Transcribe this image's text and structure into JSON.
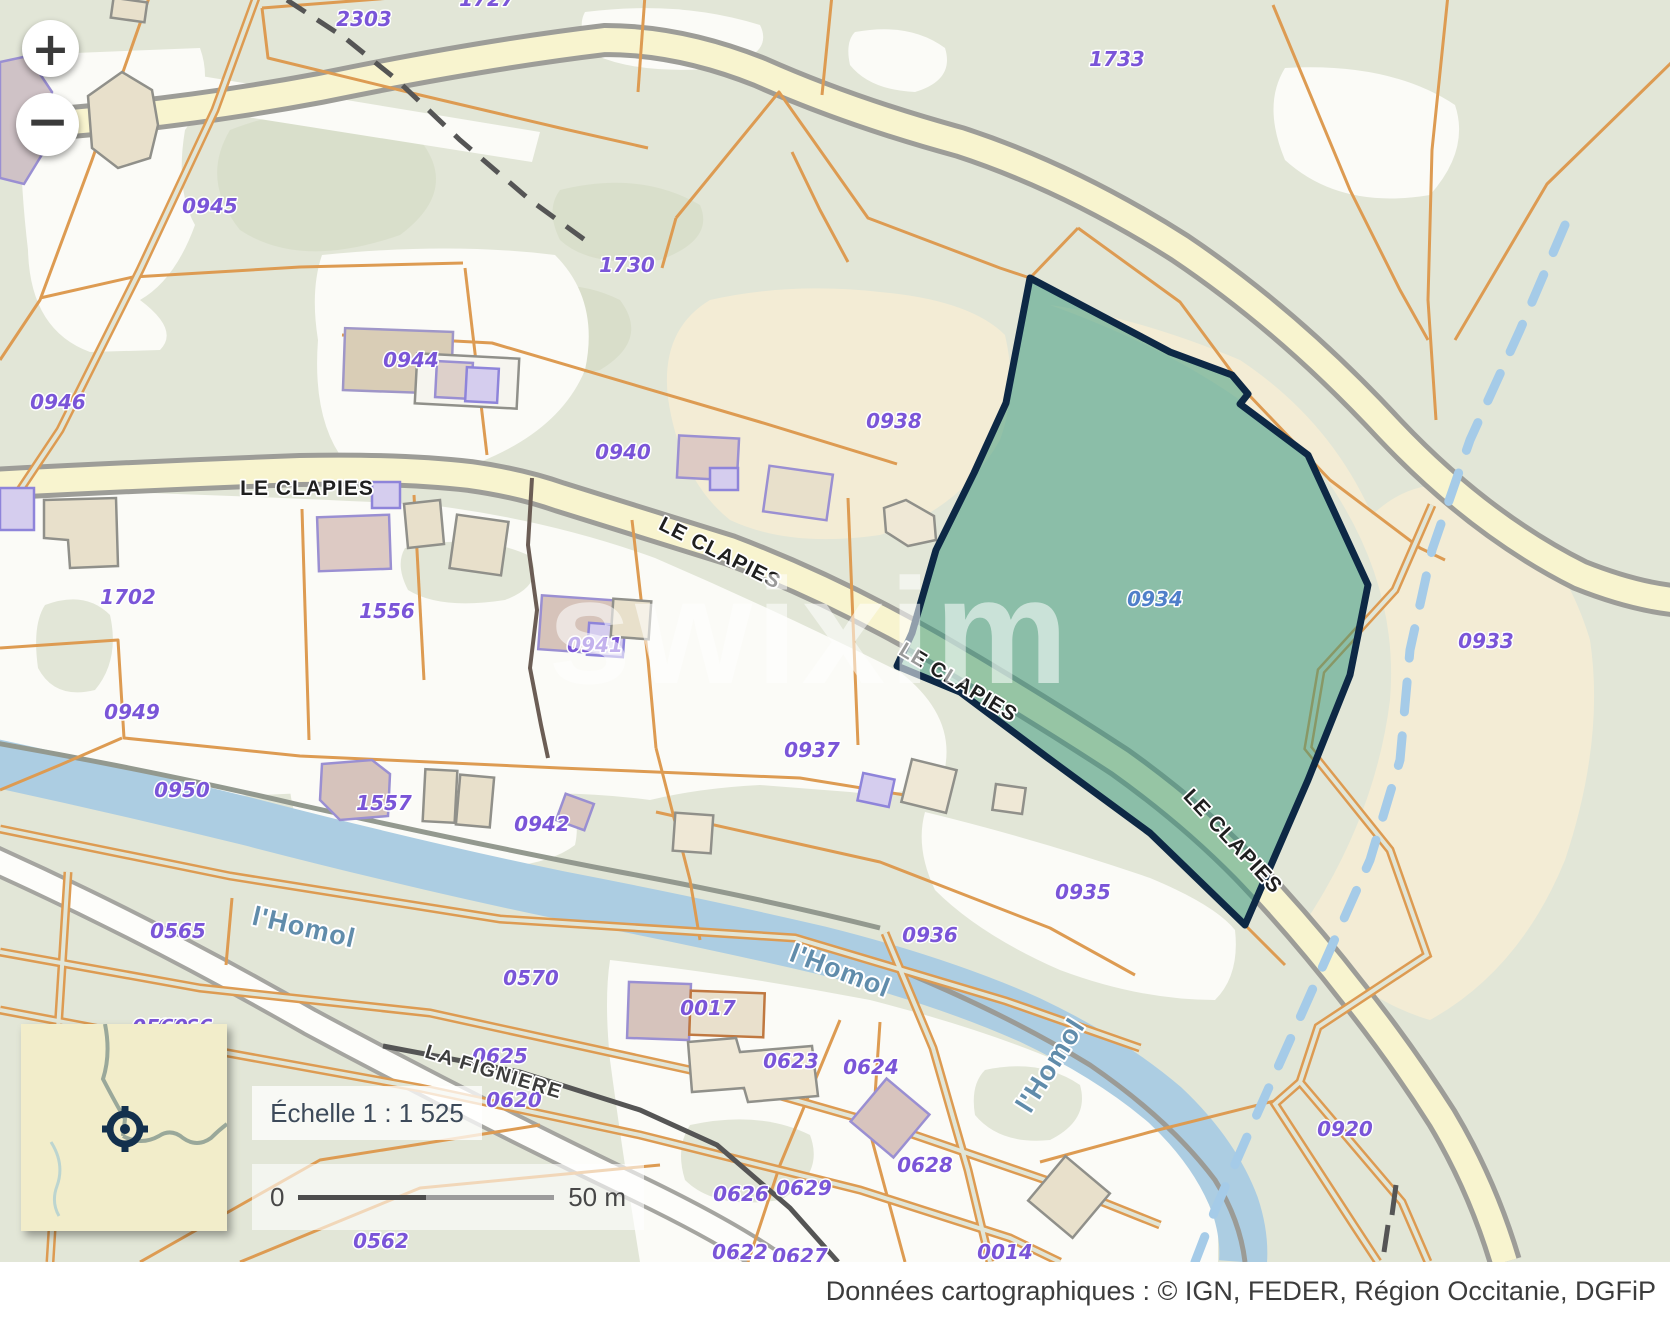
{
  "colors": {
    "base_green": "#e2e6d7",
    "patch_green": "#d7ddc8",
    "white_parcel": "#fbfbf7",
    "beige": "#f3ecd5",
    "river": "#accde2",
    "road_fill": "#f8f4cf",
    "road_casing": "#9d9d98",
    "orange_line": "#dd9b52",
    "highlight_fill": "rgba(52,150,122,0.5)",
    "highlight_border": "#0d2845",
    "parcel_label": "#7a55d8",
    "selected_parcel_label": "#4f7fc9",
    "dashed_stream": "#a5cbe8"
  },
  "controls": {
    "zoom_in": "+",
    "zoom_out": "−"
  },
  "scale": {
    "text": "Échelle 1 : 1 525",
    "bar_start": "0",
    "bar_end": "50 m"
  },
  "watermark": {
    "text": "swixim"
  },
  "attribution": {
    "text": "Données cartographiques : ©    IGN,  FEDER,  Région Occitanie,  DGFiP"
  },
  "selected_parcel": {
    "id": "0934"
  },
  "map_labels": [
    {
      "text": "1727",
      "x": 487,
      "y": 6,
      "rot": 0,
      "cls": "p",
      "name": "parcel-label-1727"
    },
    {
      "text": "2303",
      "x": 364,
      "y": 26,
      "rot": 0,
      "cls": "p",
      "name": "parcel-label-2303"
    },
    {
      "text": "1733",
      "x": 1117,
      "y": 66,
      "rot": 0,
      "cls": "p",
      "name": "parcel-label-1733"
    },
    {
      "text": "0945",
      "x": 210,
      "y": 213,
      "rot": 0,
      "cls": "p",
      "name": "parcel-label-0945"
    },
    {
      "text": "1730",
      "x": 627,
      "y": 272,
      "rot": 0,
      "cls": "p",
      "name": "parcel-label-1730"
    },
    {
      "text": "0946",
      "x": 58,
      "y": 409,
      "rot": 0,
      "cls": "p",
      "name": "parcel-label-0946"
    },
    {
      "text": "0944",
      "x": 411,
      "y": 367,
      "rot": 0,
      "cls": "p",
      "name": "parcel-label-0944"
    },
    {
      "text": "0940",
      "x": 623,
      "y": 459,
      "rot": 0,
      "cls": "p",
      "name": "parcel-label-0940"
    },
    {
      "text": "0938",
      "x": 894,
      "y": 428,
      "rot": 0,
      "cls": "p",
      "name": "parcel-label-0938"
    },
    {
      "text": "0934",
      "x": 1155,
      "y": 606,
      "rot": 0,
      "cls": "pb",
      "name": "parcel-label-0934-selected"
    },
    {
      "text": "0933",
      "x": 1486,
      "y": 648,
      "rot": 0,
      "cls": "p",
      "name": "parcel-label-0933"
    },
    {
      "text": "1702",
      "x": 128,
      "y": 604,
      "rot": 0,
      "cls": "p",
      "name": "parcel-label-1702"
    },
    {
      "text": "1556",
      "x": 387,
      "y": 618,
      "rot": 0,
      "cls": "p",
      "name": "parcel-label-1556"
    },
    {
      "text": "0941",
      "x": 595,
      "y": 652,
      "rot": 0,
      "cls": "p",
      "name": "parcel-label-0941"
    },
    {
      "text": "0949",
      "x": 132,
      "y": 719,
      "rot": 0,
      "cls": "p",
      "name": "parcel-label-0949"
    },
    {
      "text": "0937",
      "x": 812,
      "y": 757,
      "rot": 0,
      "cls": "p",
      "name": "parcel-label-0937"
    },
    {
      "text": "0950",
      "x": 182,
      "y": 797,
      "rot": 0,
      "cls": "p",
      "name": "parcel-label-0950"
    },
    {
      "text": "1557",
      "x": 384,
      "y": 810,
      "rot": 0,
      "cls": "p",
      "name": "parcel-label-1557"
    },
    {
      "text": "0942",
      "x": 542,
      "y": 831,
      "rot": 0,
      "cls": "p",
      "name": "parcel-label-0942"
    },
    {
      "text": "0935",
      "x": 1083,
      "y": 899,
      "rot": 0,
      "cls": "p",
      "name": "parcel-label-0935"
    },
    {
      "text": "0936",
      "x": 930,
      "y": 942,
      "rot": 0,
      "cls": "p",
      "name": "parcel-label-0936"
    },
    {
      "text": "0565",
      "x": 178,
      "y": 938,
      "rot": 0,
      "cls": "p",
      "name": "parcel-label-0565"
    },
    {
      "text": "0566",
      "x": 185,
      "y": 1034,
      "rot": 0,
      "cls": "p",
      "name": "parcel-label-0566"
    },
    {
      "text": "0560",
      "x": 160,
      "y": 1034,
      "rot": 0,
      "cls": "p",
      "name": "parcel-label-0560"
    },
    {
      "text": "0570",
      "x": 531,
      "y": 985,
      "rot": 0,
      "cls": "p",
      "name": "parcel-label-0570"
    },
    {
      "text": "0625",
      "x": 500,
      "y": 1063,
      "rot": 0,
      "cls": "p",
      "name": "parcel-label-0625"
    },
    {
      "text": "0620",
      "x": 514,
      "y": 1107,
      "rot": 0,
      "cls": "p",
      "name": "parcel-label-0620"
    },
    {
      "text": "0626",
      "x": 741,
      "y": 1201,
      "rot": 0,
      "cls": "p",
      "name": "parcel-label-0626"
    },
    {
      "text": "0629",
      "x": 804,
      "y": 1195,
      "rot": 0,
      "cls": "p",
      "name": "parcel-label-0629"
    },
    {
      "text": "0628",
      "x": 925,
      "y": 1172,
      "rot": 0,
      "cls": "p",
      "name": "parcel-label-0628"
    },
    {
      "text": "0623",
      "x": 791,
      "y": 1068,
      "rot": 0,
      "cls": "p",
      "name": "parcel-label-0623"
    },
    {
      "text": "0624",
      "x": 871,
      "y": 1074,
      "rot": 0,
      "cls": "p",
      "name": "parcel-label-0624"
    },
    {
      "text": "0017",
      "x": 708,
      "y": 1015,
      "rot": 0,
      "cls": "p",
      "name": "parcel-label-0017"
    },
    {
      "text": "0014",
      "x": 1005,
      "y": 1259,
      "rot": 0,
      "cls": "p",
      "name": "parcel-label-0014"
    },
    {
      "text": "0562",
      "x": 381,
      "y": 1248,
      "rot": 0,
      "cls": "p",
      "name": "parcel-label-0562"
    },
    {
      "text": "0920",
      "x": 1345,
      "y": 1136,
      "rot": 0,
      "cls": "p",
      "name": "parcel-label-0920"
    },
    {
      "text": "0622",
      "x": 740,
      "y": 1259,
      "rot": 0,
      "cls": "p",
      "name": "parcel-label-0622"
    },
    {
      "text": "0627",
      "x": 800,
      "y": 1263,
      "rot": 0,
      "cls": "p",
      "name": "parcel-label-0627"
    },
    {
      "text": "LE CLAPIES",
      "x": 307,
      "y": 495,
      "rot": 0,
      "cls": "r",
      "name": "road-label-le-clapies-1"
    },
    {
      "text": "LE CLAPIES",
      "x": 717,
      "y": 559,
      "rot": 27,
      "cls": "r",
      "name": "road-label-le-clapies-2"
    },
    {
      "text": "LE CLAPIES",
      "x": 955,
      "y": 688,
      "rot": 31,
      "cls": "r",
      "name": "road-label-le-clapies-3"
    },
    {
      "text": "LE CLAPIES",
      "x": 1228,
      "y": 846,
      "rot": 47,
      "cls": "r",
      "name": "road-label-le-clapies-4"
    },
    {
      "text": "LA FIGNIERE",
      "x": 492,
      "y": 1078,
      "rot": 17,
      "cls": "f",
      "name": "road-label-la-figniere"
    },
    {
      "text": "l'Homol",
      "x": 302,
      "y": 936,
      "rot": 13,
      "cls": "w",
      "name": "river-label-lhomol-1"
    },
    {
      "text": "l'Homol",
      "x": 837,
      "y": 979,
      "rot": 21,
      "cls": "w",
      "name": "river-label-lhomol-2"
    },
    {
      "text": "l'Homol",
      "x": 1058,
      "y": 1070,
      "rot": -58,
      "cls": "w",
      "name": "river-label-lhomol-3"
    }
  ]
}
